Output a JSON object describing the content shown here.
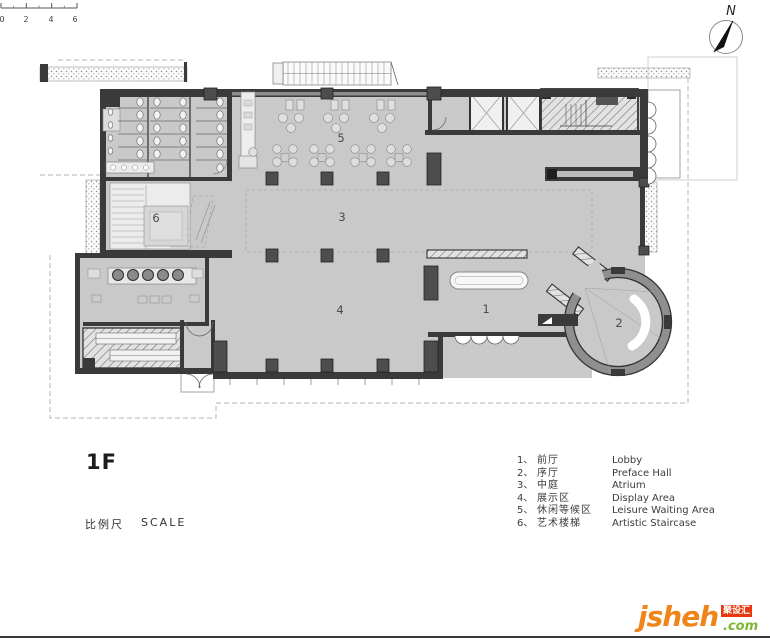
{
  "north": {
    "label": "N"
  },
  "title_block": {
    "floor": "1F"
  },
  "scale_bar": {
    "t0": "0",
    "t1": "2",
    "t2": "4",
    "t3": "6",
    "label_cn": "比例尺",
    "label_en": "SCALE"
  },
  "plan": {
    "room_labels": [
      {
        "number": "1"
      },
      {
        "number": "2"
      },
      {
        "number": "3"
      },
      {
        "number": "4"
      },
      {
        "number": "5"
      },
      {
        "number": "6"
      }
    ]
  },
  "legend": {
    "items": [
      {
        "index": "1、",
        "cn": "前厅",
        "en": "Lobby"
      },
      {
        "index": "2、",
        "cn": "序厅",
        "en": "Preface Hall"
      },
      {
        "index": "3、",
        "cn": "中庭",
        "en": "Atrium"
      },
      {
        "index": "4、",
        "cn": "展示区",
        "en": "Display Area"
      },
      {
        "index": "5、",
        "cn": "休闲等候区",
        "en": "Leisure Waiting Area"
      },
      {
        "index": "6、",
        "cn": "艺术楼梯",
        "en": "Artistic Staircase"
      }
    ]
  },
  "watermark": {
    "brand": "jsheh",
    "tld": ".com",
    "badge": "聚设汇"
  },
  "colors": {
    "floor": "#c9c9c9",
    "wall": "#3a3a3a",
    "brand_orange": "#f08419",
    "brand_green": "#7fb633",
    "badge_red": "#e8380d"
  }
}
